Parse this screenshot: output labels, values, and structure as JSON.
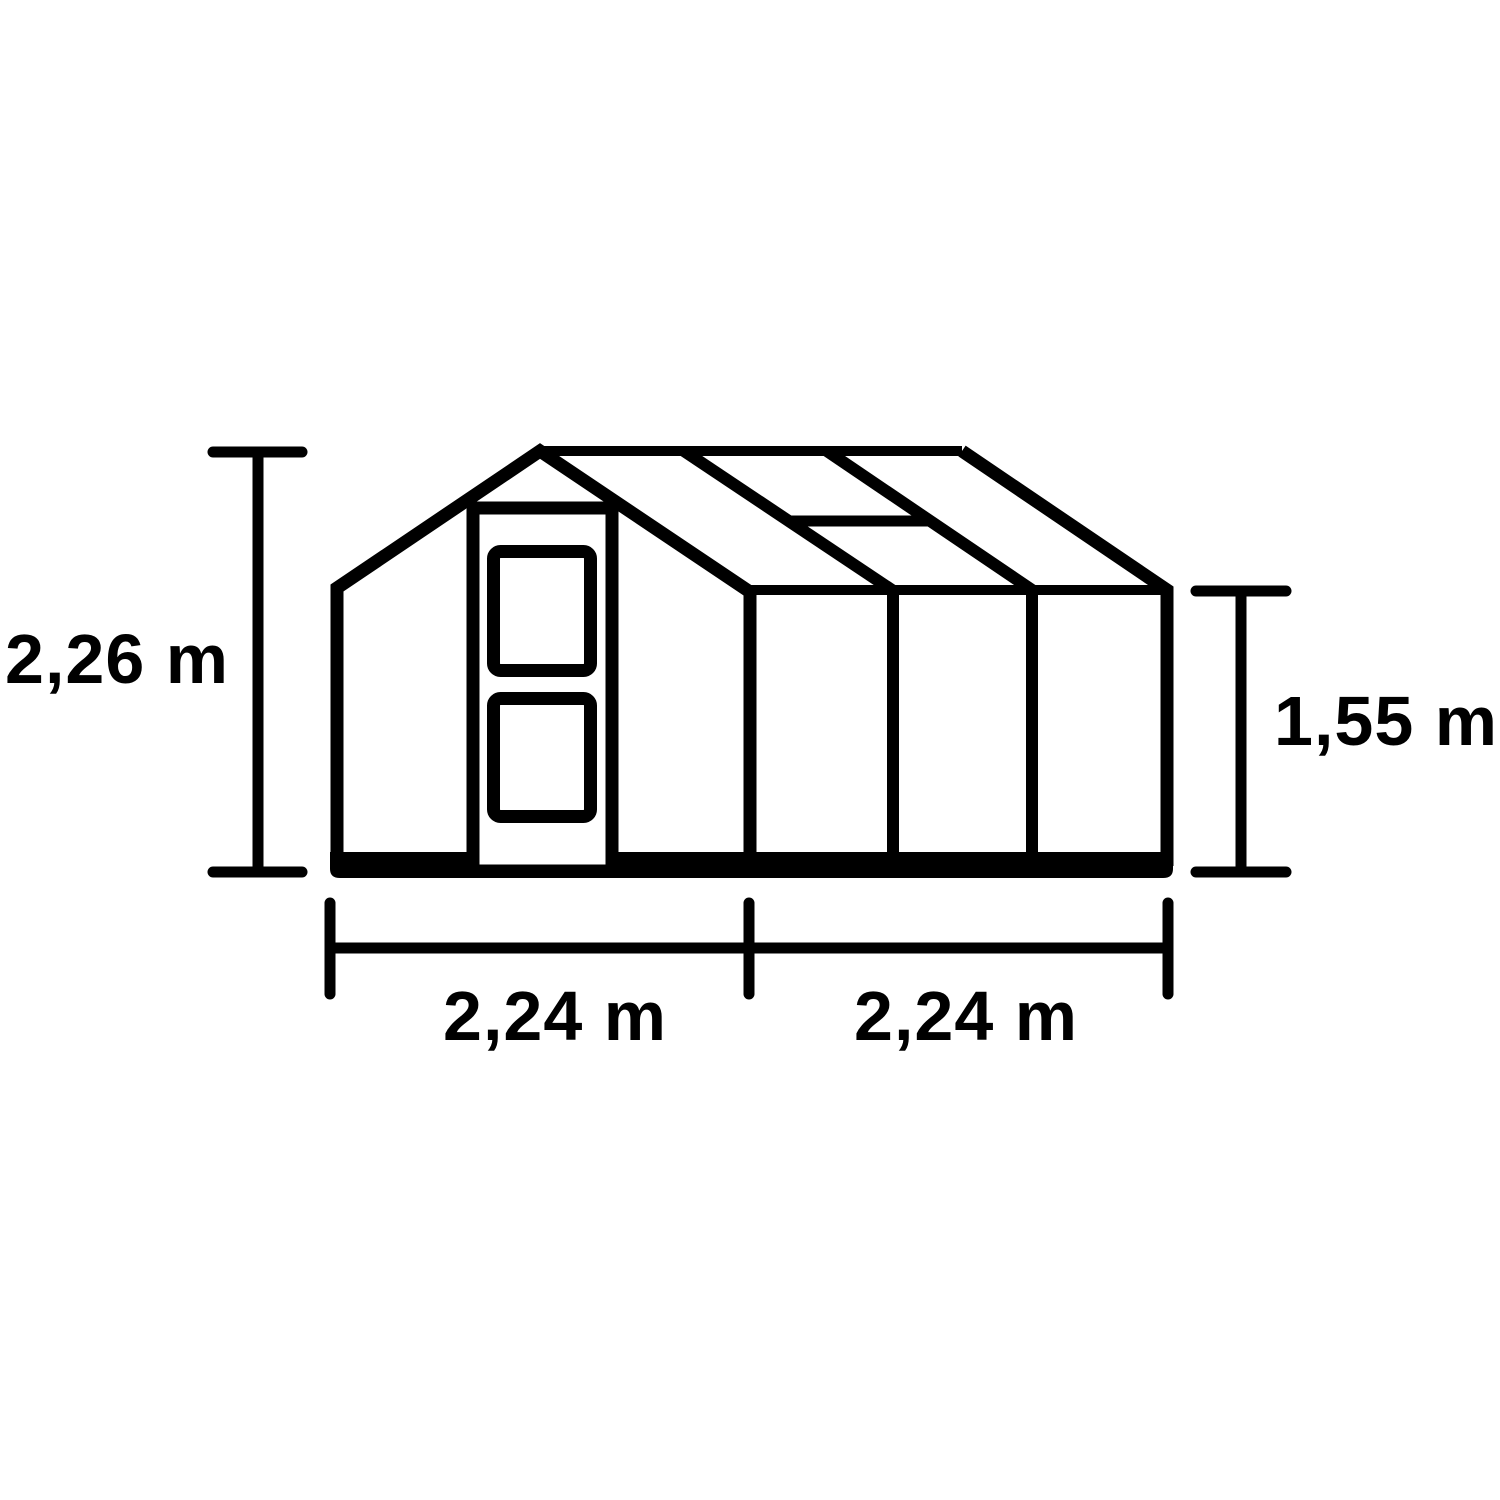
{
  "diagram": {
    "type": "greenhouse-dimension-diagram",
    "line_color": "#000000",
    "background_color": "#ffffff",
    "dimension_labels": {
      "left_total_height": "2,26 m",
      "right_eave_height": "1,55 m",
      "bottom_front_width": "2,24 m",
      "bottom_side_depth": "2,24 m"
    },
    "structure": {
      "front_door_panels": 2,
      "side_wall_bays": 3,
      "roof_panels": 3,
      "roof_vent": 1
    }
  }
}
